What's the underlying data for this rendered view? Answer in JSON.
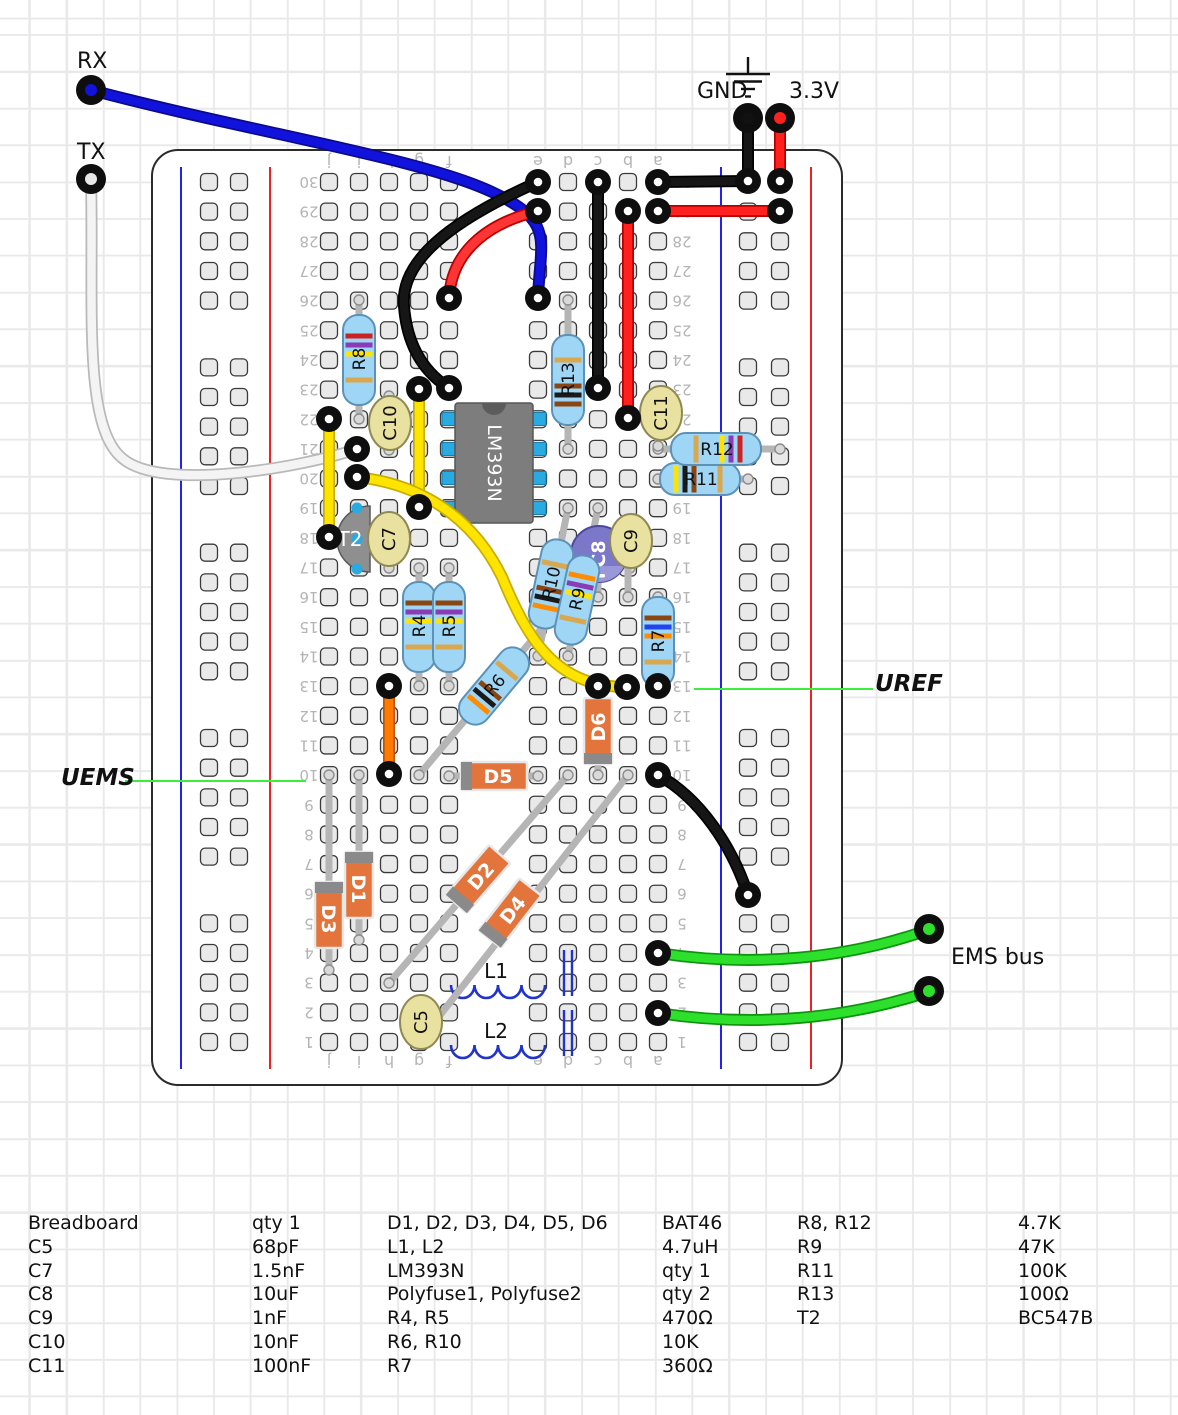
{
  "annotations": {
    "rx": {
      "text": "RX",
      "x": 77,
      "y": 49
    },
    "tx": {
      "text": "TX",
      "x": 77,
      "y": 140
    },
    "gnd": {
      "text": "GND",
      "x": 697,
      "y": 79
    },
    "v33": {
      "text": "3.3V",
      "x": 789,
      "y": 79
    },
    "uref": {
      "text": "UREF",
      "x": 875,
      "y": 671
    },
    "uems": {
      "text": "UEMS",
      "x": 61,
      "y": 765
    },
    "ems_bus": {
      "text": "EMS bus",
      "x": 951,
      "y": 945
    }
  },
  "board": {
    "column_letters": [
      "j",
      "i",
      "h",
      "g",
      "f",
      "e",
      "d",
      "c",
      "b",
      "a"
    ],
    "row_count": 30
  },
  "components": {
    "ic": {
      "ref": "LM393N",
      "label": "LM393N",
      "body": [
        455,
        403,
        78,
        120
      ],
      "pin_rows_y": [
        419,
        449,
        478,
        508
      ]
    },
    "resistors": [
      {
        "ref": "R8",
        "value": "4.7K",
        "cx": 359,
        "cy": 360,
        "angle": -90,
        "half": 45,
        "bside": 1,
        "lead": [
          359,
          300,
          359,
          419
        ],
        "bands": [
          "#ffe400",
          "#8a3bb5",
          "#cc2222"
        ]
      },
      {
        "ref": "R13",
        "value": "100Ω",
        "cx": 568,
        "cy": 380,
        "angle": -90,
        "half": 45,
        "bside": -1,
        "lead": [
          568,
          300,
          568,
          449
        ],
        "bands": [
          "#8B4513",
          "#1a1a1a",
          "#8B4513"
        ]
      },
      {
        "ref": "R4",
        "value": "470Ω",
        "cx": 419,
        "cy": 627,
        "angle": -90,
        "half": 45,
        "bside": 1,
        "lead": [
          419,
          568,
          419,
          686
        ],
        "bands": [
          "#ffe400",
          "#8a3bb5",
          "#8B4513"
        ]
      },
      {
        "ref": "R5",
        "value": "470Ω",
        "cx": 449,
        "cy": 627,
        "angle": -90,
        "half": 45,
        "bside": 1,
        "lead": [
          449,
          568,
          449,
          686
        ],
        "bands": [
          "#ffe400",
          "#8a3bb5",
          "#8B4513"
        ]
      },
      {
        "ref": "R7",
        "value": "360Ω",
        "cx": 658,
        "cy": 642,
        "angle": -90,
        "half": 45,
        "bside": 1,
        "lead": [
          658,
          597,
          658,
          688
        ],
        "bands": [
          "#ff8c00",
          "#2244ee",
          "#8B4513"
        ]
      },
      {
        "ref": "R6",
        "value": "10K",
        "cx": 494,
        "cy": 686,
        "angle": -50,
        "half": 45,
        "bside": -1,
        "lead": [
          419,
          775,
          568,
          597
        ],
        "bands": [
          "#8B4513",
          "#1a1a1a",
          "#ff8c00"
        ]
      },
      {
        "ref": "R10",
        "value": "10K",
        "cx": 551,
        "cy": 584,
        "angle": -78,
        "half": 45,
        "bside": -1,
        "lead": [
          538,
          656,
          568,
          508
        ],
        "bands": [
          "#8B4513",
          "#1a1a1a",
          "#ff8c00"
        ]
      },
      {
        "ref": "R9",
        "value": "47K",
        "cx": 577,
        "cy": 600,
        "angle": -78,
        "half": 45,
        "bside": 1,
        "lead": [
          568,
          656,
          598,
          508
        ],
        "bands": [
          "#ffe400",
          "#8a3bb5",
          "#ff8c00"
        ]
      },
      {
        "ref": "R11",
        "value": "100K",
        "cx": 700,
        "cy": 479,
        "angle": 0,
        "half": 40,
        "bside": -1,
        "lead": [
          658,
          479,
          748,
          479
        ],
        "bands": [
          "#8B4513",
          "#1a1a1a",
          "#ffe400"
        ]
      },
      {
        "ref": "R12",
        "value": "4.7K",
        "cx": 716,
        "cy": 449,
        "angle": 0,
        "half": 45,
        "bside": 1,
        "lead": [
          658,
          449,
          780,
          449
        ],
        "bands": [
          "#ffe400",
          "#8a3bb5",
          "#cc2222"
        ]
      }
    ],
    "diodes": [
      {
        "ref": "D1",
        "cx": 359,
        "cy": 885,
        "angle": 90,
        "lead": [
          359,
          775,
          359,
          940
        ]
      },
      {
        "ref": "D3",
        "cx": 329,
        "cy": 915,
        "angle": 90,
        "lead": [
          329,
          775,
          329,
          970
        ]
      },
      {
        "ref": "D5",
        "cx": 494,
        "cy": 776,
        "angle": 0,
        "lead": [
          449,
          776,
          538,
          776
        ]
      },
      {
        "ref": "D6",
        "cx": 598,
        "cy": 731,
        "angle": -90,
        "lead": [
          598,
          686,
          598,
          775
        ]
      },
      {
        "ref": "D2",
        "cx": 478,
        "cy": 879,
        "angle": -49,
        "lead": [
          389,
          983,
          568,
          775
        ]
      },
      {
        "ref": "D4",
        "cx": 510,
        "cy": 913,
        "angle": -52,
        "lead": [
          419,
          1042,
          628,
          775
        ]
      }
    ],
    "ceramic_caps": [
      {
        "ref": "C10",
        "cx": 390,
        "cy": 423,
        "lead": [
          389,
          396,
          389,
          450
        ]
      },
      {
        "ref": "C7",
        "cx": 389,
        "cy": 539,
        "lead": [
          389,
          539,
          389,
          568
        ]
      },
      {
        "ref": "C9",
        "cx": 631,
        "cy": 541,
        "lead": [
          630,
          541,
          630,
          568
        ]
      },
      {
        "ref": "C5",
        "cx": 421,
        "cy": 1022
      },
      {
        "ref": "C11",
        "cx": 661,
        "cy": 413,
        "lead": [
          658,
          392,
          658,
          446
        ]
      }
    ],
    "electrolytic": {
      "ref": "C8",
      "cx": 599,
      "cy": 554,
      "r": 28,
      "leads": [
        [
          598,
          554,
          598,
          597
        ],
        [
          628,
          554,
          628,
          597
        ]
      ]
    },
    "transistor": {
      "ref": "T2",
      "cx": 351,
      "cy": 539,
      "dots": [
        [
          357,
          508
        ],
        [
          357,
          539
        ],
        [
          357,
          569
        ]
      ]
    },
    "inductors": [
      {
        "ref": "L1",
        "x1": 451,
        "x2": 545,
        "y": 985,
        "lx": 496,
        "ly": 978
      },
      {
        "ref": "L2",
        "x1": 451,
        "x2": 545,
        "y": 1045,
        "lx": 496,
        "ly": 1038
      }
    ],
    "polyfuses": [
      {
        "ref": "Polyfuse1",
        "x": 568,
        "y1": 950,
        "y2": 996
      },
      {
        "ref": "Polyfuse2",
        "x": 568,
        "y1": 1010,
        "y2": 1056
      }
    ]
  },
  "wires": [
    {
      "id": "rx-wire",
      "color": "#1212dd",
      "dark": "#0a0a8c",
      "d": "M91,90 C250,132 420,158 492,192 C556,222 540,240 538,298",
      "rings": [
        [
          538,
          298
        ]
      ]
    },
    {
      "id": "tx-wire",
      "color": "#f4f4f4",
      "dark": "#b9b9b9",
      "d": "M91,179 C94,300 82,425 122,458 C160,492 300,468 357,449",
      "rings": [
        [
          357,
          449
        ]
      ]
    },
    {
      "id": "gnd-drop",
      "color": "#161616",
      "dark": "#000000",
      "d": "M748,118 L748,181",
      "rings": [
        [
          748,
          181
        ]
      ]
    },
    {
      "id": "gnd-row30",
      "color": "#161616",
      "dark": "#000000",
      "d": "M658,182 L748,181",
      "rings": [
        [
          658,
          182
        ]
      ]
    },
    {
      "id": "v33-drop",
      "color": "#ff2020",
      "dark": "#b80000",
      "d": "M780,118 L780,181",
      "rings": [
        [
          780,
          181
        ]
      ]
    },
    {
      "id": "v33-row29",
      "color": "#ff2020",
      "dark": "#b80000",
      "d": "M658,211 L780,211",
      "rings": [
        [
          658,
          211
        ],
        [
          780,
          211
        ]
      ]
    },
    {
      "id": "black-arc",
      "color": "#161616",
      "dark": "#000000",
      "d": "M538,182 C448,222 400,262 404,306 C407,346 424,372 449,388",
      "rings": [
        [
          538,
          182
        ],
        [
          449,
          388
        ]
      ]
    },
    {
      "id": "black-c30-c23",
      "color": "#161616",
      "dark": "#000000",
      "d": "M598,182 L598,388",
      "rings": [
        [
          598,
          182
        ],
        [
          598,
          388
        ]
      ]
    },
    {
      "id": "red-b29-b22",
      "color": "#ff2020",
      "dark": "#b80000",
      "d": "M628,211 L628,418",
      "rings": [
        [
          628,
          211
        ],
        [
          628,
          418
        ]
      ]
    },
    {
      "id": "red-e29-f26",
      "color": "#ff3535",
      "dark": "#b80000",
      "d": "M538,211 C492,222 452,248 449,298",
      "rings": [
        [
          538,
          211
        ],
        [
          449,
          298
        ]
      ]
    },
    {
      "id": "yellow-j",
      "color": "#ffe400",
      "dark": "#c7ae00",
      "d": "M329,419 L329,537",
      "rings": [
        [
          329,
          419
        ],
        [
          329,
          537
        ]
      ]
    },
    {
      "id": "yellow-g",
      "color": "#ffe400",
      "dark": "#c7ae00",
      "d": "M419,389 L419,507",
      "rings": [
        [
          419,
          389
        ],
        [
          419,
          507
        ]
      ]
    },
    {
      "id": "yellow-curve",
      "color": "#ffe400",
      "dark": "#c7ae00",
      "d": "M357,477 C420,484 472,516 502,577 C528,640 556,687 627,687",
      "rings": [
        [
          357,
          477
        ],
        [
          627,
          687
        ]
      ]
    },
    {
      "id": "orange-h13",
      "color": "#ff7a00",
      "dark": "#c25400",
      "d": "M389,686 L389,774",
      "rings": [
        [
          389,
          686
        ],
        [
          389,
          774
        ]
      ]
    },
    {
      "id": "black-a10",
      "color": "#161616",
      "dark": "#000000",
      "d": "M658,775 C700,798 732,846 748,895",
      "rings": [
        [
          658,
          775
        ],
        [
          748,
          895
        ]
      ]
    },
    {
      "id": "green-ems-1",
      "color": "#2ce02c",
      "dark": "#0f930f",
      "d": "M658,953 C756,968 848,958 928,930",
      "rings": [
        [
          658,
          953
        ]
      ]
    },
    {
      "id": "green-ems-2",
      "color": "#2ce02c",
      "dark": "#0f930f",
      "d": "M658,1013 C756,1028 848,1018 928,992",
      "rings": [
        [
          658,
          1013
        ]
      ]
    }
  ],
  "extra_rings": [
    [
      598,
      686
    ],
    [
      658,
      686
    ]
  ],
  "pins": [
    {
      "ref": "RX",
      "x": 91,
      "y": 90,
      "core": "#1212dd"
    },
    {
      "ref": "TX",
      "x": 91,
      "y": 179,
      "core": "#e8e8e8"
    },
    {
      "ref": "GND",
      "x": 748,
      "y": 118,
      "core": "#111111"
    },
    {
      "ref": "3.3V",
      "x": 780,
      "y": 118,
      "core": "#ff2020"
    },
    {
      "ref": "EMS1",
      "x": 929,
      "y": 929,
      "core": "#2ce02c"
    },
    {
      "ref": "EMS2",
      "x": 929,
      "y": 991,
      "core": "#2ce02c"
    }
  ],
  "net_lines": {
    "uems": [
      125,
      781,
      306,
      781
    ],
    "uref": [
      694,
      689,
      873,
      689
    ]
  },
  "parts_list": {
    "rows": [
      [
        "Breadboard",
        "qty 1",
        "D1, D2, D3, D4, D5, D6",
        "BAT46",
        "R8, R12",
        "4.7K"
      ],
      [
        "C5",
        "68pF",
        "L1, L2",
        "4.7uH",
        "R9",
        "47K"
      ],
      [
        "C7",
        "1.5nF",
        "LM393N",
        "qty 1",
        "R11",
        "100K"
      ],
      [
        "C8",
        "10uF",
        "Polyfuse1, Polyfuse2",
        "qty 2",
        "R13",
        "100Ω"
      ],
      [
        "C9",
        "1nF",
        "R4, R5",
        "470Ω",
        "T2",
        "BC547B"
      ],
      [
        "C10",
        "10nF",
        "R6, R10",
        "10K",
        "",
        ""
      ],
      [
        "C11",
        "100nF",
        "R7",
        "360Ω",
        "",
        ""
      ]
    ]
  }
}
